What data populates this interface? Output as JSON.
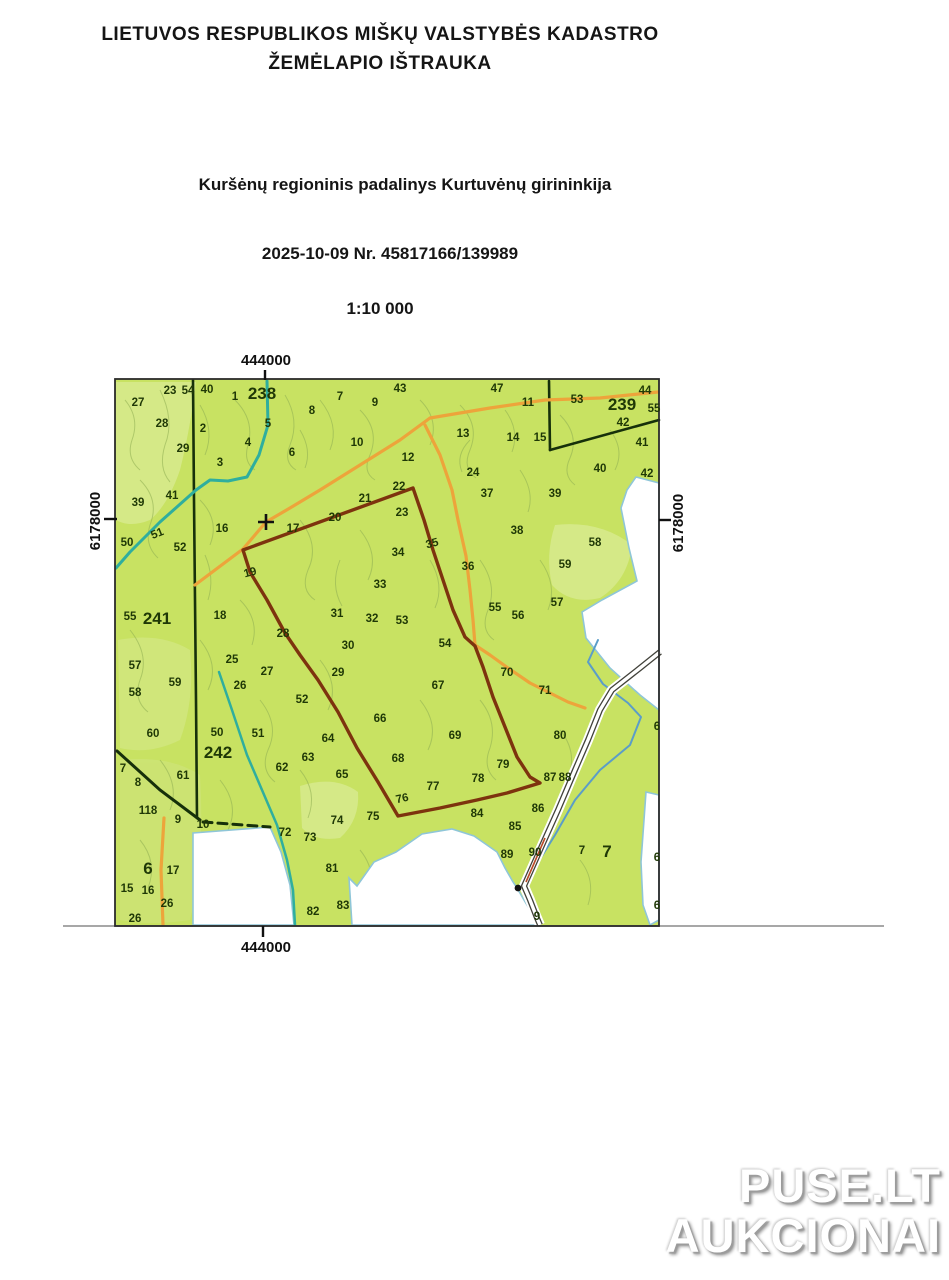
{
  "header": {
    "title_line1": "LIETUVOS RESPUBLIKOS MIŠKŲ VALSTYBĖS KADASTRO",
    "title_line2": "ŽEMĖLAPIO IŠTRAUKA",
    "subtitle": "Kuršėnų regioninis padalinys Kurtuvėnų girininkija",
    "date_number": "2025-10-09  Nr. 45817166/139989",
    "scale": "1:10 000"
  },
  "watermark": {
    "line1": "PUSE.LT",
    "line2": "AUKCIONAI"
  },
  "map": {
    "frame": {
      "x": 115,
      "y": 379,
      "w": 544,
      "h": 547
    },
    "coordinates": {
      "top": "444000",
      "bottom": "444000",
      "left": "6178000",
      "right": "6178000"
    },
    "colors": {
      "forest": "#c8e262",
      "forest_light": "#ddeea2",
      "white_edge": "#8fc6d8",
      "stream_teal": "#2fae9e",
      "stream_blue": "#5b9dc8",
      "road_orange": "#eda43b",
      "highlight": "#7d330e",
      "boundary_dark": "#16300a",
      "label": "#1f3806",
      "frame_line": "#2b2b2b",
      "road_casing": "#41413a",
      "road_red": "#b84a28"
    },
    "white_areas": [
      {
        "name": "white-area-east",
        "pts": [
          [
            636,
            477
          ],
          [
            659,
            483
          ],
          [
            659,
            710
          ],
          [
            640,
            695
          ],
          [
            610,
            668
          ],
          [
            586,
            638
          ],
          [
            582,
            612
          ],
          [
            602,
            600
          ],
          [
            637,
            581
          ],
          [
            629,
            548
          ],
          [
            621,
            508
          ],
          [
            627,
            490
          ]
        ]
      },
      {
        "name": "white-area-south-left",
        "pts": [
          [
            193,
            833
          ],
          [
            270,
            827
          ],
          [
            281,
            852
          ],
          [
            290,
            885
          ],
          [
            294,
            925
          ],
          [
            193,
            925
          ]
        ]
      },
      {
        "name": "white-area-south-right",
        "pts": [
          [
            352,
            925
          ],
          [
            349,
            878
          ],
          [
            357,
            886
          ],
          [
            374,
            862
          ],
          [
            396,
            852
          ],
          [
            422,
            834
          ],
          [
            452,
            829
          ],
          [
            474,
            836
          ],
          [
            497,
            852
          ],
          [
            505,
            868
          ],
          [
            513,
            882
          ],
          [
            517,
            888
          ],
          [
            524,
            900
          ],
          [
            533,
            915
          ],
          [
            537,
            925
          ]
        ]
      },
      {
        "name": "white-area-se-border",
        "pts": [
          [
            646,
            792
          ],
          [
            659,
            795
          ],
          [
            659,
            920
          ],
          [
            650,
            925
          ],
          [
            643,
            905
          ],
          [
            641,
            862
          ],
          [
            644,
            820
          ]
        ]
      }
    ],
    "boundaries": [
      {
        "name": "block-boundary-238-west",
        "pts": [
          [
            193,
            380
          ],
          [
            194,
            500
          ],
          [
            195,
            600
          ],
          [
            196,
            700
          ],
          [
            197,
            818
          ]
        ],
        "w": 2.6
      },
      {
        "name": "block-boundary-sw",
        "pts": [
          [
            117,
            751
          ],
          [
            160,
            790
          ],
          [
            200,
            820
          ]
        ],
        "w": 3
      },
      {
        "name": "block-boundary-sw-dashed",
        "pts": [
          [
            203,
            822
          ],
          [
            270,
            827
          ]
        ],
        "w": 3,
        "dash": "9,6"
      },
      {
        "name": "block-boundary-239-a",
        "pts": [
          [
            549,
            381
          ],
          [
            550,
            450
          ]
        ],
        "w": 2.6
      },
      {
        "name": "block-boundary-239-b",
        "pts": [
          [
            550,
            450
          ],
          [
            659,
            420
          ]
        ],
        "w": 2.6
      }
    ],
    "streams": [
      {
        "name": "stream-northwest",
        "color": "#2fae9e",
        "w": 3,
        "pts": [
          [
            267,
            381
          ],
          [
            268,
            425
          ],
          [
            259,
            455
          ],
          [
            247,
            477
          ],
          [
            228,
            481
          ],
          [
            210,
            480
          ],
          [
            196,
            490
          ],
          [
            160,
            522
          ],
          [
            130,
            552
          ],
          [
            116,
            568
          ]
        ]
      },
      {
        "name": "stream-southwest",
        "color": "#2fae9e",
        "w": 2.5,
        "pts": [
          [
            219,
            672
          ],
          [
            232,
            710
          ],
          [
            247,
            755
          ],
          [
            262,
            790
          ],
          [
            277,
            825
          ],
          [
            287,
            860
          ],
          [
            293,
            890
          ],
          [
            295,
            925
          ]
        ]
      },
      {
        "name": "stream-southeast",
        "color": "#5b9dc8",
        "w": 2,
        "pts": [
          [
            598,
            640
          ],
          [
            588,
            662
          ],
          [
            603,
            684
          ],
          [
            628,
            703
          ],
          [
            641,
            717
          ],
          [
            630,
            745
          ],
          [
            600,
            770
          ],
          [
            575,
            800
          ],
          [
            555,
            835
          ],
          [
            532,
            872
          ],
          [
            521,
            888
          ],
          [
            528,
            903
          ],
          [
            536,
            918
          ]
        ]
      }
    ],
    "orange_roads": [
      {
        "name": "road-orange-north",
        "pts": [
          [
            658,
            392
          ],
          [
            600,
            398
          ],
          [
            545,
            400
          ],
          [
            490,
            408
          ],
          [
            430,
            418
          ],
          [
            400,
            440
          ],
          [
            360,
            465
          ],
          [
            320,
            490
          ],
          [
            290,
            508
          ],
          [
            266,
            522
          ],
          [
            243,
            549
          ],
          [
            215,
            570
          ],
          [
            195,
            585
          ]
        ]
      },
      {
        "name": "road-orange-central",
        "pts": [
          [
            425,
            425
          ],
          [
            440,
            455
          ],
          [
            452,
            490
          ],
          [
            458,
            520
          ],
          [
            466,
            556
          ],
          [
            470,
            590
          ],
          [
            473,
            620
          ],
          [
            475,
            645
          ],
          [
            490,
            655
          ],
          [
            508,
            668
          ],
          [
            530,
            683
          ],
          [
            548,
            692
          ],
          [
            568,
            702
          ],
          [
            585,
            708
          ]
        ]
      },
      {
        "name": "road-orange-southwest",
        "pts": [
          [
            164,
            818
          ],
          [
            161,
            870
          ],
          [
            163,
            925
          ]
        ]
      }
    ],
    "main_road": {
      "name": "road-gravel-southeast",
      "pts": [
        [
          660,
          652
        ],
        [
          640,
          668
        ],
        [
          612,
          690
        ],
        [
          600,
          710
        ],
        [
          588,
          740
        ],
        [
          575,
          770
        ],
        [
          558,
          810
        ],
        [
          540,
          850
        ],
        [
          524,
          886
        ],
        [
          530,
          900
        ],
        [
          537,
          918
        ],
        [
          540,
          925
        ]
      ]
    },
    "road_red_accent": {
      "pts": [
        [
          545,
          838
        ],
        [
          526,
          882
        ]
      ]
    },
    "highlight_polygon": {
      "name": "highlighted-parcel-boundary",
      "pts": [
        [
          243,
          550
        ],
        [
          413,
          488
        ],
        [
          424,
          520
        ],
        [
          433,
          550
        ],
        [
          443,
          580
        ],
        [
          453,
          610
        ],
        [
          465,
          637
        ],
        [
          475,
          646
        ],
        [
          483,
          667
        ],
        [
          493,
          697
        ],
        [
          505,
          727
        ],
        [
          517,
          757
        ],
        [
          530,
          777
        ],
        [
          540,
          783
        ],
        [
          507,
          793
        ],
        [
          477,
          800
        ],
        [
          440,
          808
        ],
        [
          398,
          816
        ],
        [
          378,
          782
        ],
        [
          357,
          748
        ],
        [
          338,
          712
        ],
        [
          318,
          680
        ],
        [
          300,
          655
        ],
        [
          285,
          633
        ],
        [
          267,
          600
        ],
        [
          250,
          572
        ]
      ]
    },
    "cross_marker": {
      "x": 266,
      "y": 522
    },
    "dot_marker": {
      "x": 518,
      "y": 888
    },
    "block_labels": [
      [
        "238",
        262,
        393
      ],
      [
        "239",
        622,
        404
      ],
      [
        "241",
        157,
        618
      ],
      [
        "242",
        218,
        752
      ],
      [
        "6",
        148,
        868
      ],
      [
        "7",
        607,
        851
      ]
    ],
    "parcel_labels": [
      [
        "23",
        170,
        390
      ],
      [
        "54",
        188,
        390
      ],
      [
        "40",
        207,
        389
      ],
      [
        "1",
        235,
        396
      ],
      [
        "43",
        400,
        388
      ],
      [
        "47",
        497,
        388
      ],
      [
        "11",
        528,
        402
      ],
      [
        "53",
        577,
        399
      ],
      [
        "44",
        645,
        390
      ],
      [
        "55",
        654,
        408
      ],
      [
        "27",
        138,
        402
      ],
      [
        "28",
        162,
        423
      ],
      [
        "2",
        203,
        428
      ],
      [
        "5",
        268,
        423
      ],
      [
        "8",
        312,
        410
      ],
      [
        "7",
        340,
        396
      ],
      [
        "9",
        375,
        402
      ],
      [
        "10",
        357,
        442
      ],
      [
        "6",
        292,
        452
      ],
      [
        "4",
        248,
        442
      ],
      [
        "3",
        220,
        462
      ],
      [
        "29",
        183,
        448
      ],
      [
        "12",
        408,
        457
      ],
      [
        "13",
        463,
        433
      ],
      [
        "14",
        513,
        437
      ],
      [
        "15",
        540,
        437
      ],
      [
        "24",
        473,
        472
      ],
      [
        "42",
        623,
        422
      ],
      [
        "41",
        642,
        442
      ],
      [
        "40",
        600,
        468
      ],
      [
        "42",
        647,
        473
      ],
      [
        "37",
        487,
        493
      ],
      [
        "39",
        555,
        493
      ],
      [
        "39",
        138,
        502
      ],
      [
        "41",
        172,
        495
      ],
      [
        "22",
        399,
        486
      ],
      [
        "21",
        365,
        498
      ],
      [
        "20",
        335,
        517
      ],
      [
        "17",
        293,
        528
      ],
      [
        "16",
        222,
        528
      ],
      [
        "23",
        402,
        512
      ],
      [
        "50",
        127,
        542
      ],
      [
        "51",
        157,
        533,
        -22
      ],
      [
        "52",
        180,
        547
      ],
      [
        "34",
        398,
        552
      ],
      [
        "35",
        432,
        543,
        -15
      ],
      [
        "36",
        468,
        566
      ],
      [
        "38",
        517,
        530
      ],
      [
        "58",
        595,
        542
      ],
      [
        "59",
        565,
        564
      ],
      [
        "33",
        380,
        584
      ],
      [
        "31",
        337,
        613
      ],
      [
        "32",
        372,
        618
      ],
      [
        "53",
        402,
        620
      ],
      [
        "55",
        495,
        607
      ],
      [
        "56",
        518,
        615
      ],
      [
        "57",
        557,
        602
      ],
      [
        "55",
        130,
        616
      ],
      [
        "18",
        220,
        615
      ],
      [
        "19",
        250,
        572,
        -15
      ],
      [
        "30",
        348,
        645
      ],
      [
        "29",
        338,
        672
      ],
      [
        "54",
        445,
        643
      ],
      [
        "25",
        232,
        659
      ],
      [
        "27",
        267,
        671
      ],
      [
        "26",
        240,
        685
      ],
      [
        "28",
        283,
        633
      ],
      [
        "52",
        302,
        699
      ],
      [
        "57",
        135,
        665
      ],
      [
        "59",
        175,
        682
      ],
      [
        "58",
        135,
        692
      ],
      [
        "66",
        380,
        718
      ],
      [
        "67",
        438,
        685
      ],
      [
        "70",
        507,
        672
      ],
      [
        "71",
        545,
        690
      ],
      [
        "60",
        153,
        733
      ],
      [
        "50",
        217,
        732
      ],
      [
        "51",
        258,
        733
      ],
      [
        "64",
        328,
        738
      ],
      [
        "63",
        308,
        757
      ],
      [
        "62",
        282,
        767
      ],
      [
        "65",
        342,
        774
      ],
      [
        "68",
        398,
        758
      ],
      [
        "69",
        455,
        735
      ],
      [
        "79",
        503,
        764
      ],
      [
        "80",
        560,
        735
      ],
      [
        "61",
        183,
        775
      ],
      [
        "7",
        123,
        768
      ],
      [
        "8",
        138,
        782
      ],
      [
        "118",
        148,
        810
      ],
      [
        "9",
        178,
        819
      ],
      [
        "10",
        203,
        824
      ],
      [
        "72",
        285,
        832
      ],
      [
        "73",
        310,
        837
      ],
      [
        "74",
        337,
        820
      ],
      [
        "75",
        373,
        816
      ],
      [
        "76",
        402,
        798,
        -12
      ],
      [
        "77",
        433,
        786
      ],
      [
        "78",
        478,
        778
      ],
      [
        "87",
        550,
        777
      ],
      [
        "88",
        565,
        777
      ],
      [
        "84",
        477,
        813
      ],
      [
        "85",
        515,
        826
      ],
      [
        "86",
        538,
        808
      ],
      [
        "89",
        507,
        854
      ],
      [
        "90",
        535,
        852
      ],
      [
        "17",
        173,
        870
      ],
      [
        "81",
        332,
        868
      ],
      [
        "15",
        127,
        888
      ],
      [
        "16",
        148,
        890
      ],
      [
        "26",
        167,
        903
      ],
      [
        "26",
        135,
        918
      ],
      [
        "82",
        313,
        911
      ],
      [
        "83",
        343,
        905
      ],
      [
        "7",
        582,
        850
      ],
      [
        "6",
        657,
        726
      ],
      [
        "6",
        657,
        857
      ],
      [
        "6",
        657,
        905
      ],
      [
        "9",
        537,
        916
      ]
    ]
  }
}
